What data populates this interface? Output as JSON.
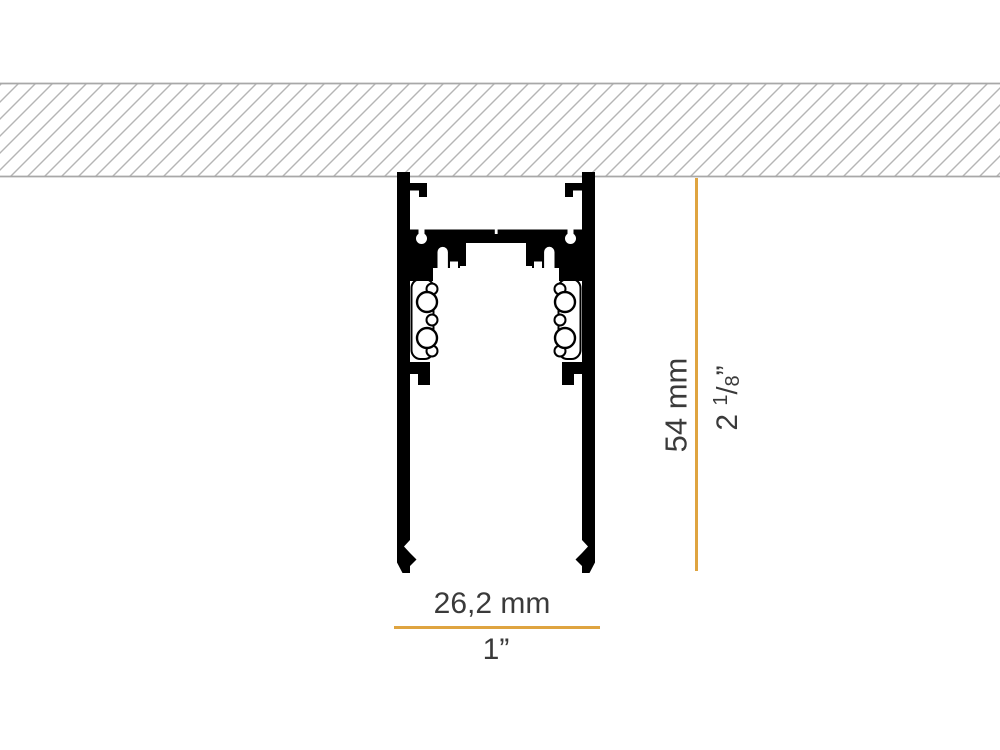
{
  "dimensions": {
    "width": {
      "metric": "26,2 mm",
      "imperial": "1”"
    },
    "height": {
      "metric": "54 mm",
      "imperial": {
        "whole": "2",
        "numerator": "1",
        "denominator": "8",
        "unit_mark": "”"
      }
    }
  },
  "colors": {
    "dimension": "#DFA440",
    "label_text": "#3A3A3A",
    "profile": "#000000",
    "hatch_line": "#B5B5B5",
    "hatch_border": "#A8A8A8"
  }
}
